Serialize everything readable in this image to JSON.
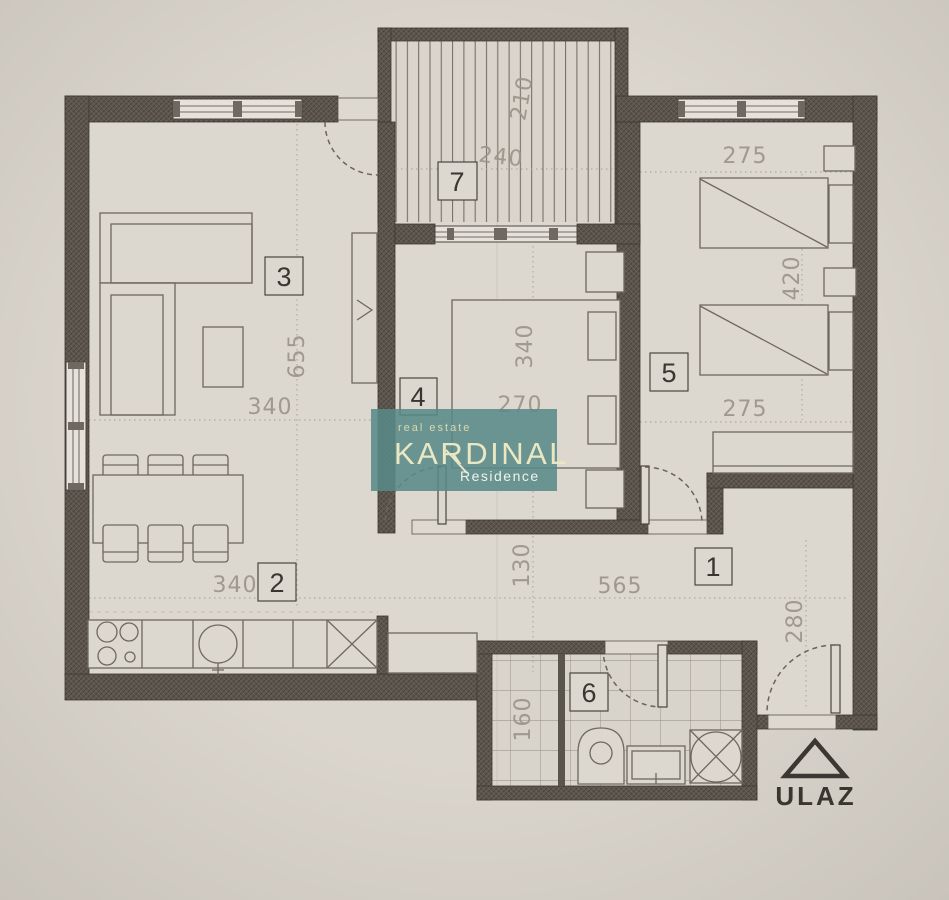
{
  "watermark": {
    "tagline": "real estate",
    "brand": "KARDINAL",
    "subtitle": "Residence",
    "accent_color": "#588a88",
    "text_color": "#eae7c3"
  },
  "entrance": {
    "label": "ULAZ"
  },
  "rooms": {
    "hallway": "1",
    "kitchen_dining": "2",
    "living": "3",
    "bedroom_main": "4",
    "bedroom_second": "5",
    "bathroom": "6",
    "balcony": "7"
  },
  "dims": {
    "balcony_depth": "210",
    "balcony_width": "240",
    "living_width": "340",
    "living_length": "655",
    "dining_width": "340",
    "bedroom4_length": "340",
    "bedroom4_width": "270",
    "bedroom5_width_top": "275",
    "bedroom5_length": "420",
    "bedroom5_width_bottom": "275",
    "hall_clear": "130",
    "hall_length": "565",
    "entry_depth": "280",
    "bath_width": "160"
  },
  "colors": {
    "paper": "#d8d3cb",
    "wall": "#5c564e",
    "line": "#6e6860",
    "dim_text": "#9a9489"
  }
}
